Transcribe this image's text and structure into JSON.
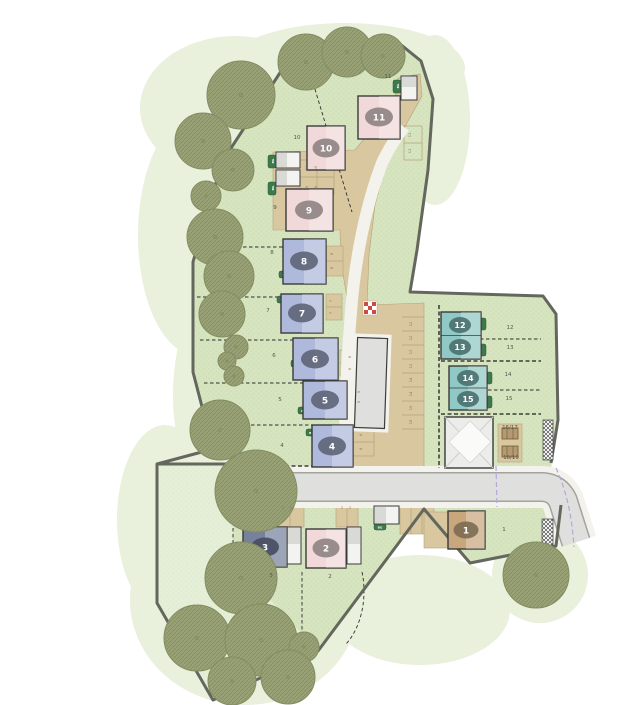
{
  "plan_type": "residential-development-site-plan",
  "plots": {
    "p1": "1",
    "p2": "2",
    "p3": "3",
    "p4": "4",
    "p5": "5",
    "p6": "6",
    "p7": "7",
    "p8": "8",
    "p9": "9",
    "p10": "10",
    "p11": "11",
    "p12": "12",
    "p13": "13",
    "p14": "14",
    "p15": "15"
  },
  "garden": {
    "g1": "1",
    "g2": "2",
    "g3": "3",
    "g4": "4",
    "g5": "5",
    "g6": "6",
    "g7": "7",
    "g8": "8",
    "g9": "9",
    "g10": "10",
    "g11": "11",
    "g12": "12",
    "g13": "13",
    "g14": "14",
    "g15": "15",
    "g16_17": "16/17",
    "g18_19": "18/19"
  },
  "bays": {
    "b2": "2",
    "b3": "3",
    "b4": "4",
    "b5": "5",
    "b6": "6",
    "b7": "7",
    "b8": "8",
    "b9": "9",
    "b10": "10",
    "b11": "11",
    "b12": "12",
    "b13": "13",
    "b14": "14",
    "b15": "15"
  },
  "store_label": "BG",
  "colors": {
    "grass": "#d7e4c0",
    "grassdot": "#c6d8aa",
    "open": "#e5eed7",
    "opendot": "#d7e4c2",
    "canopy": "#e9f0dc",
    "tree": "#99a176",
    "treeline": "#848c62",
    "road": "#dfdfdd",
    "roadedge": "#a3a39e",
    "path": "#f4f2ec",
    "tan": "#d9c7a0",
    "tanline": "#b5a278",
    "pink": "#f1d9d9",
    "blue": "#aeb9dc",
    "teal": "#8fc8c4",
    "slate": "#76819b",
    "tanh": "#c9a77d",
    "garage": "#f3f3f1",
    "bound": "#63675d",
    "store": "#3c7a4c",
    "util": "#b7a7d9",
    "accent_red": "#cc4b42",
    "ovalpink": "#8b7f80",
    "ovalblue": "#5c6274",
    "ovalteal": "#49706e",
    "ovalslate": "#474d61",
    "ovaltan": "#7d6b52"
  }
}
